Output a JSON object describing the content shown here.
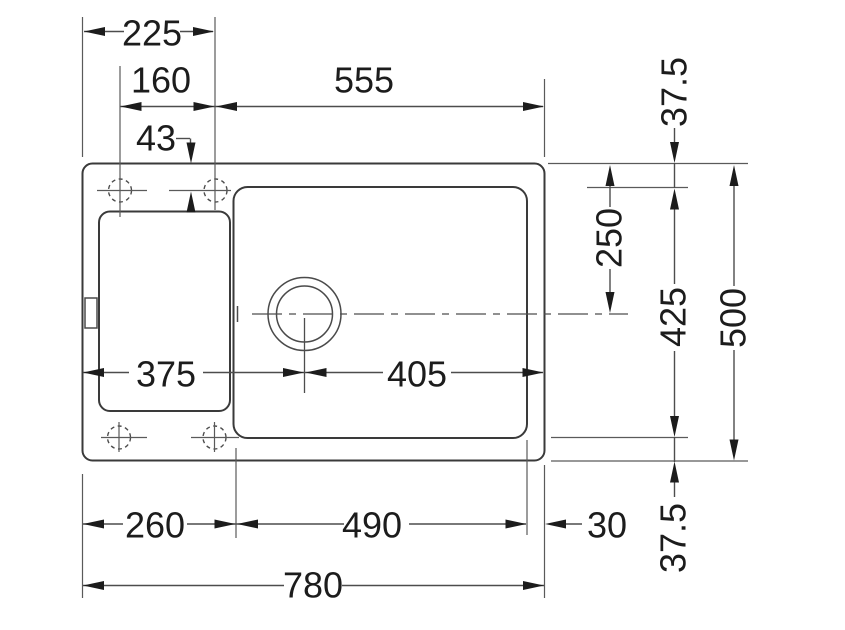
{
  "drawing": {
    "kind": "sink-cutout-technical-drawing",
    "colors": {
      "background": "#ffffff",
      "outline": "#3a3a3a",
      "dimension_lines": "#4d4d4d",
      "text": "#1c1c1c"
    },
    "dimensions": {
      "top": {
        "d225": "225",
        "d160": "160",
        "d555": "555",
        "d43": "43"
      },
      "middle": {
        "d375": "375",
        "d405": "405"
      },
      "bottom": {
        "d260": "260",
        "d490": "490",
        "d30": "30",
        "d780": "780"
      },
      "right": {
        "d37_5_top": "37.5",
        "d250": "250",
        "d425": "425",
        "d500": "500",
        "d37_5_bottom": "37.5"
      }
    }
  }
}
